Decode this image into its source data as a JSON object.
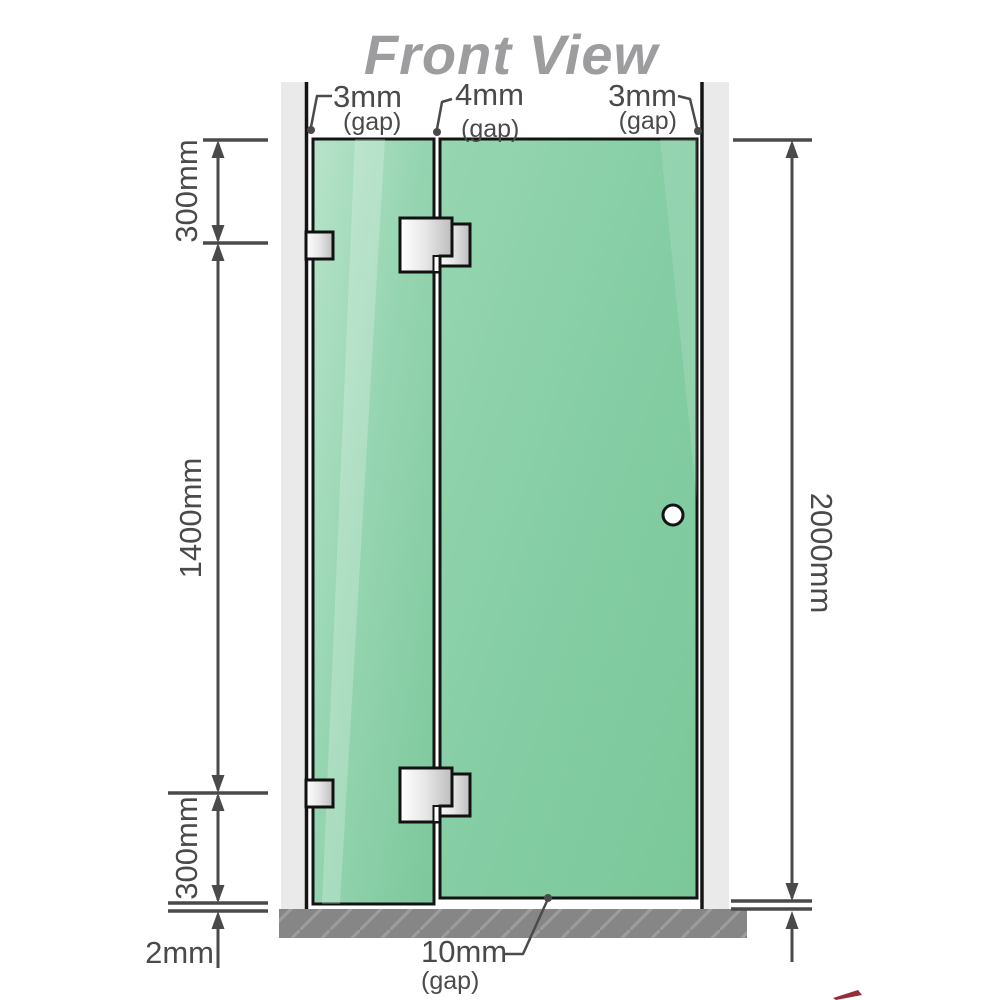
{
  "title": "Front View",
  "labels": {
    "gap_top_left": {
      "value": "3mm",
      "qualifier": "(gap)"
    },
    "gap_top_middle": {
      "value": "4mm",
      "qualifier": "(gap)"
    },
    "gap_top_right": {
      "value": "3mm",
      "qualifier": "(gap)"
    },
    "gap_bottom": {
      "value": "10mm",
      "qualifier": "(gap)"
    },
    "left_top_segment": "300mm",
    "left_middle_segment": "1400mm",
    "left_bottom_segment": "300mm",
    "floor_gap": "2mm",
    "right_total_height": "2000mm"
  },
  "colors": {
    "glass_green": "#85cda4",
    "glass_green_light": "#b5e2c8",
    "wall_gray": "#eaeaea",
    "floor_gray": "#868686",
    "dimension_gray": "#4a4a4a",
    "title_gray": "#9d9da0",
    "hardware_metal": "#d9d9d9"
  }
}
